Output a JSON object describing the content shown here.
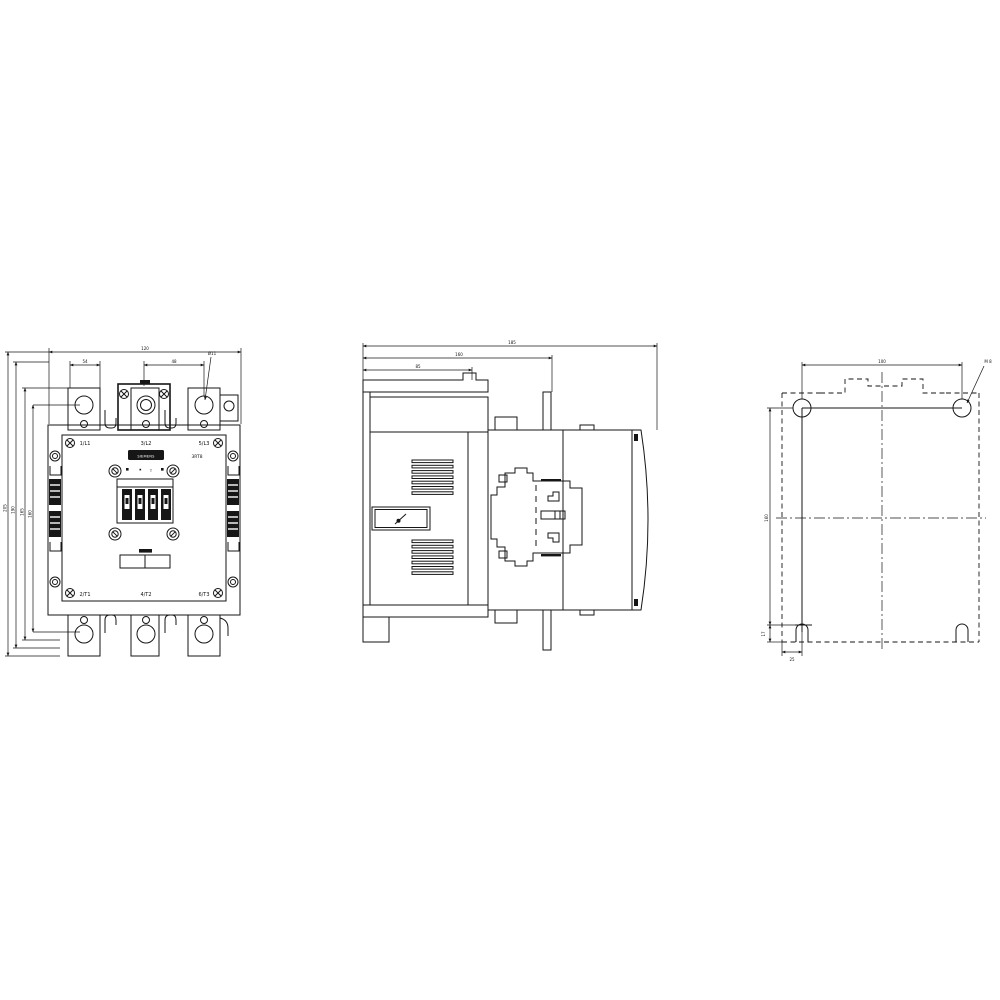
{
  "drawing": {
    "background": "#ffffff",
    "line_color": "#161616",
    "description": "contactor-dimension-drawing",
    "front": {
      "top_labels": [
        "1/L1",
        "3/L2",
        "5/L3"
      ],
      "bottom_labels": [
        "2/T1",
        "4/T2",
        "6/T3"
      ],
      "brand": "SIEMENS",
      "type_code": "3RT8",
      "t_mark": "T",
      "dims": {
        "overall_width": "120",
        "lug_pitch_left": "54",
        "lug_pitch_right": "48",
        "hole_callout": "Ø11",
        "height_outer": "205",
        "height_2": "190",
        "height_3": "165",
        "height_holes": "160"
      }
    },
    "side": {
      "dims": {
        "depth_overall": "185",
        "depth_mid": "160",
        "depth_front": "85"
      }
    },
    "mounting": {
      "dims": {
        "hole_spacing": "100",
        "hole_callout": "M 8",
        "height_left": "160",
        "slot_depth": "17",
        "slot_offset": "25"
      }
    }
  }
}
